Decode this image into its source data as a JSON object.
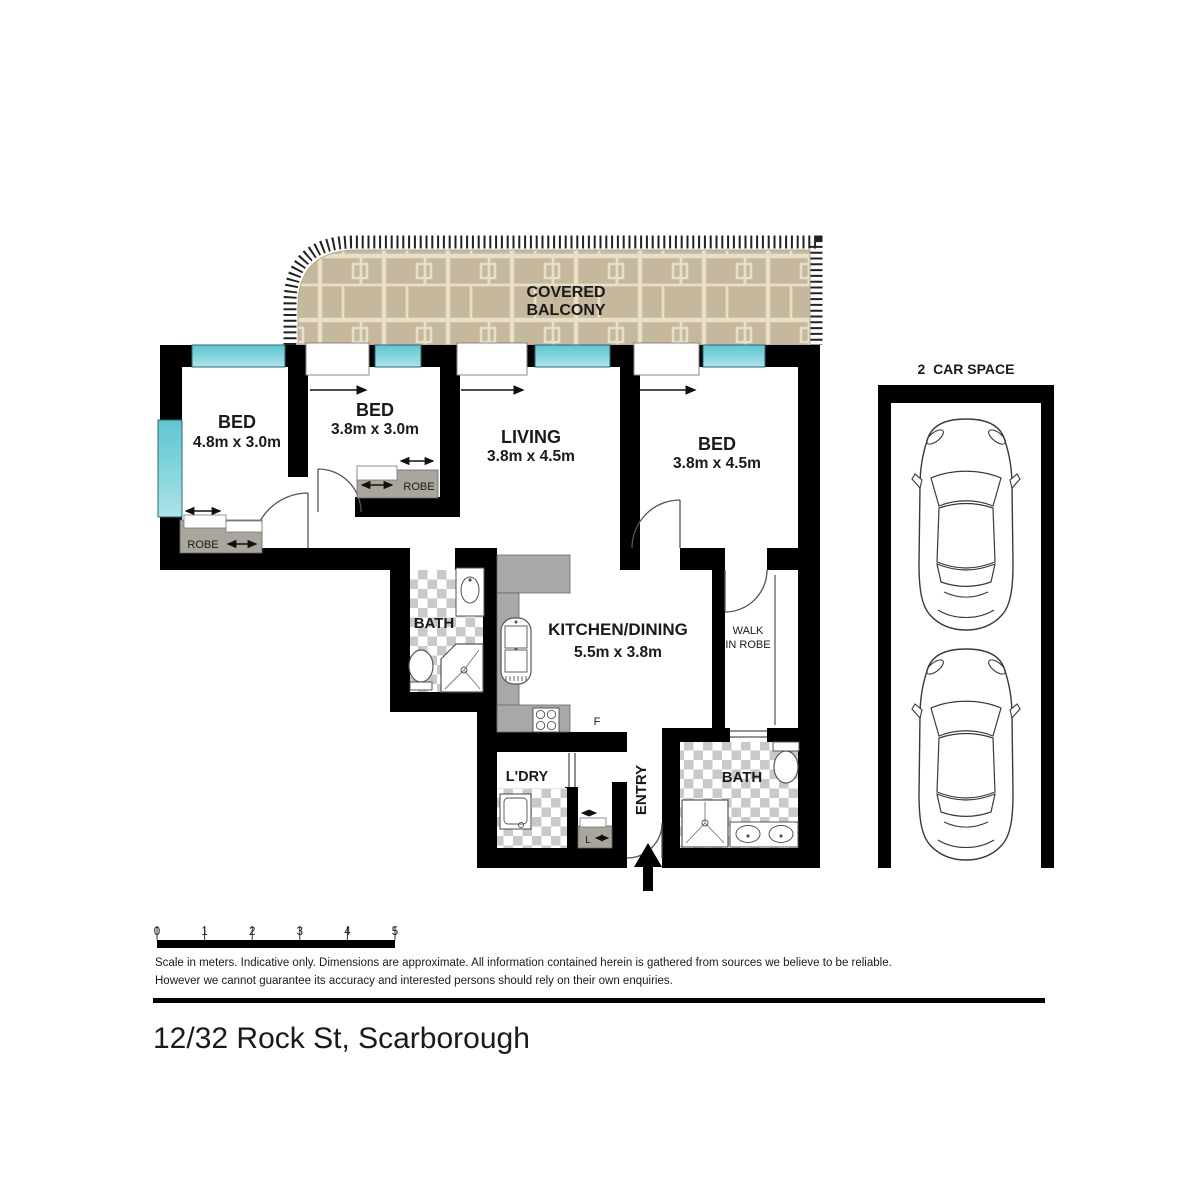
{
  "address": "12/32 Rock St, Scarborough",
  "balcony": {
    "line1": "COVERED",
    "line2": "BALCONY"
  },
  "rooms": {
    "bed1": {
      "name": "BED",
      "dims": "4.8m x 3.0m"
    },
    "bed2": {
      "name": "BED",
      "dims": "3.8m x 3.0m"
    },
    "bed3": {
      "name": "BED",
      "dims": "3.8m x 4.5m"
    },
    "living": {
      "name": "LIVING",
      "dims": "3.8m x 4.5m"
    },
    "kitchen": {
      "name": "KITCHEN/DINING",
      "dims": "5.5m x 3.8m"
    },
    "bath1": {
      "name": "BATH"
    },
    "bath2": {
      "name": "BATH"
    },
    "laundry": {
      "name": "L'DRY"
    },
    "entry": {
      "name": "ENTRY"
    },
    "walk_in_robe": {
      "line1": "WALK",
      "line2": "IN ROBE"
    },
    "robe_bed1": {
      "label": "ROBE"
    },
    "robe_bed2": {
      "label": "ROBE"
    },
    "linen": {
      "label": "L"
    },
    "fridge": {
      "label": "F"
    }
  },
  "car_space": {
    "title": "2  CAR SPACE"
  },
  "scale_bar": {
    "ticks": [
      "0",
      "1",
      "2",
      "3",
      "4",
      "5"
    ]
  },
  "disclaimer": {
    "line1": "Scale in meters. Indicative only. Dimensions are approximate. All information contained herein is gathered from sources we believe to be reliable.",
    "line2": "However we cannot guarantee its accuracy and interested persons should rely on their own enquiries."
  },
  "colors": {
    "wall": "#000000",
    "window": "#7ed3db",
    "window_dark": "#55c0cc",
    "paver_base": "#c6b89c",
    "paver_grout": "#e8dfc8",
    "tile_gray": "#c9c9c9",
    "counter_gray": "#a8a8a8",
    "robe_gray": "#aba69d"
  }
}
